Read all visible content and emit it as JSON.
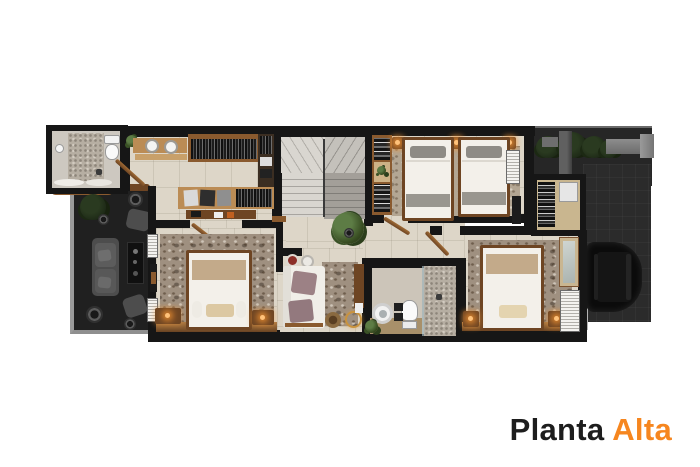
{
  "title": {
    "word_dark": "Planta",
    "word_accent": "Alta"
  },
  "palette": {
    "canvas": "#ffffff",
    "accent": "#f6861f",
    "title-text": "#1d1d1d",
    "wall": "#161616",
    "floor": "#ddd6c8",
    "wood": "#8a5a2e",
    "wood-light": "#bb8c55",
    "wood-dark": "#6e4523",
    "rug": "#9f9080",
    "rug-light": "#b3a693",
    "mosaic": "#b6aea2",
    "bedding": "#f3f0ea",
    "tan": "#c3aa8a",
    "pillow-gray": "#8e8b85",
    "mauve": "#9c8185",
    "stair-light": "#d9d6d0",
    "stair-dark": "#a39f99",
    "void-bg": "#202020",
    "void-furniture": "#4d4d4d",
    "garden": "#262626",
    "drive": "#2b2b2b",
    "car": "#0b0b0b",
    "plant": "#35491f",
    "concrete": "#9a9a9a",
    "shutter": "#f4f3f0"
  }
}
